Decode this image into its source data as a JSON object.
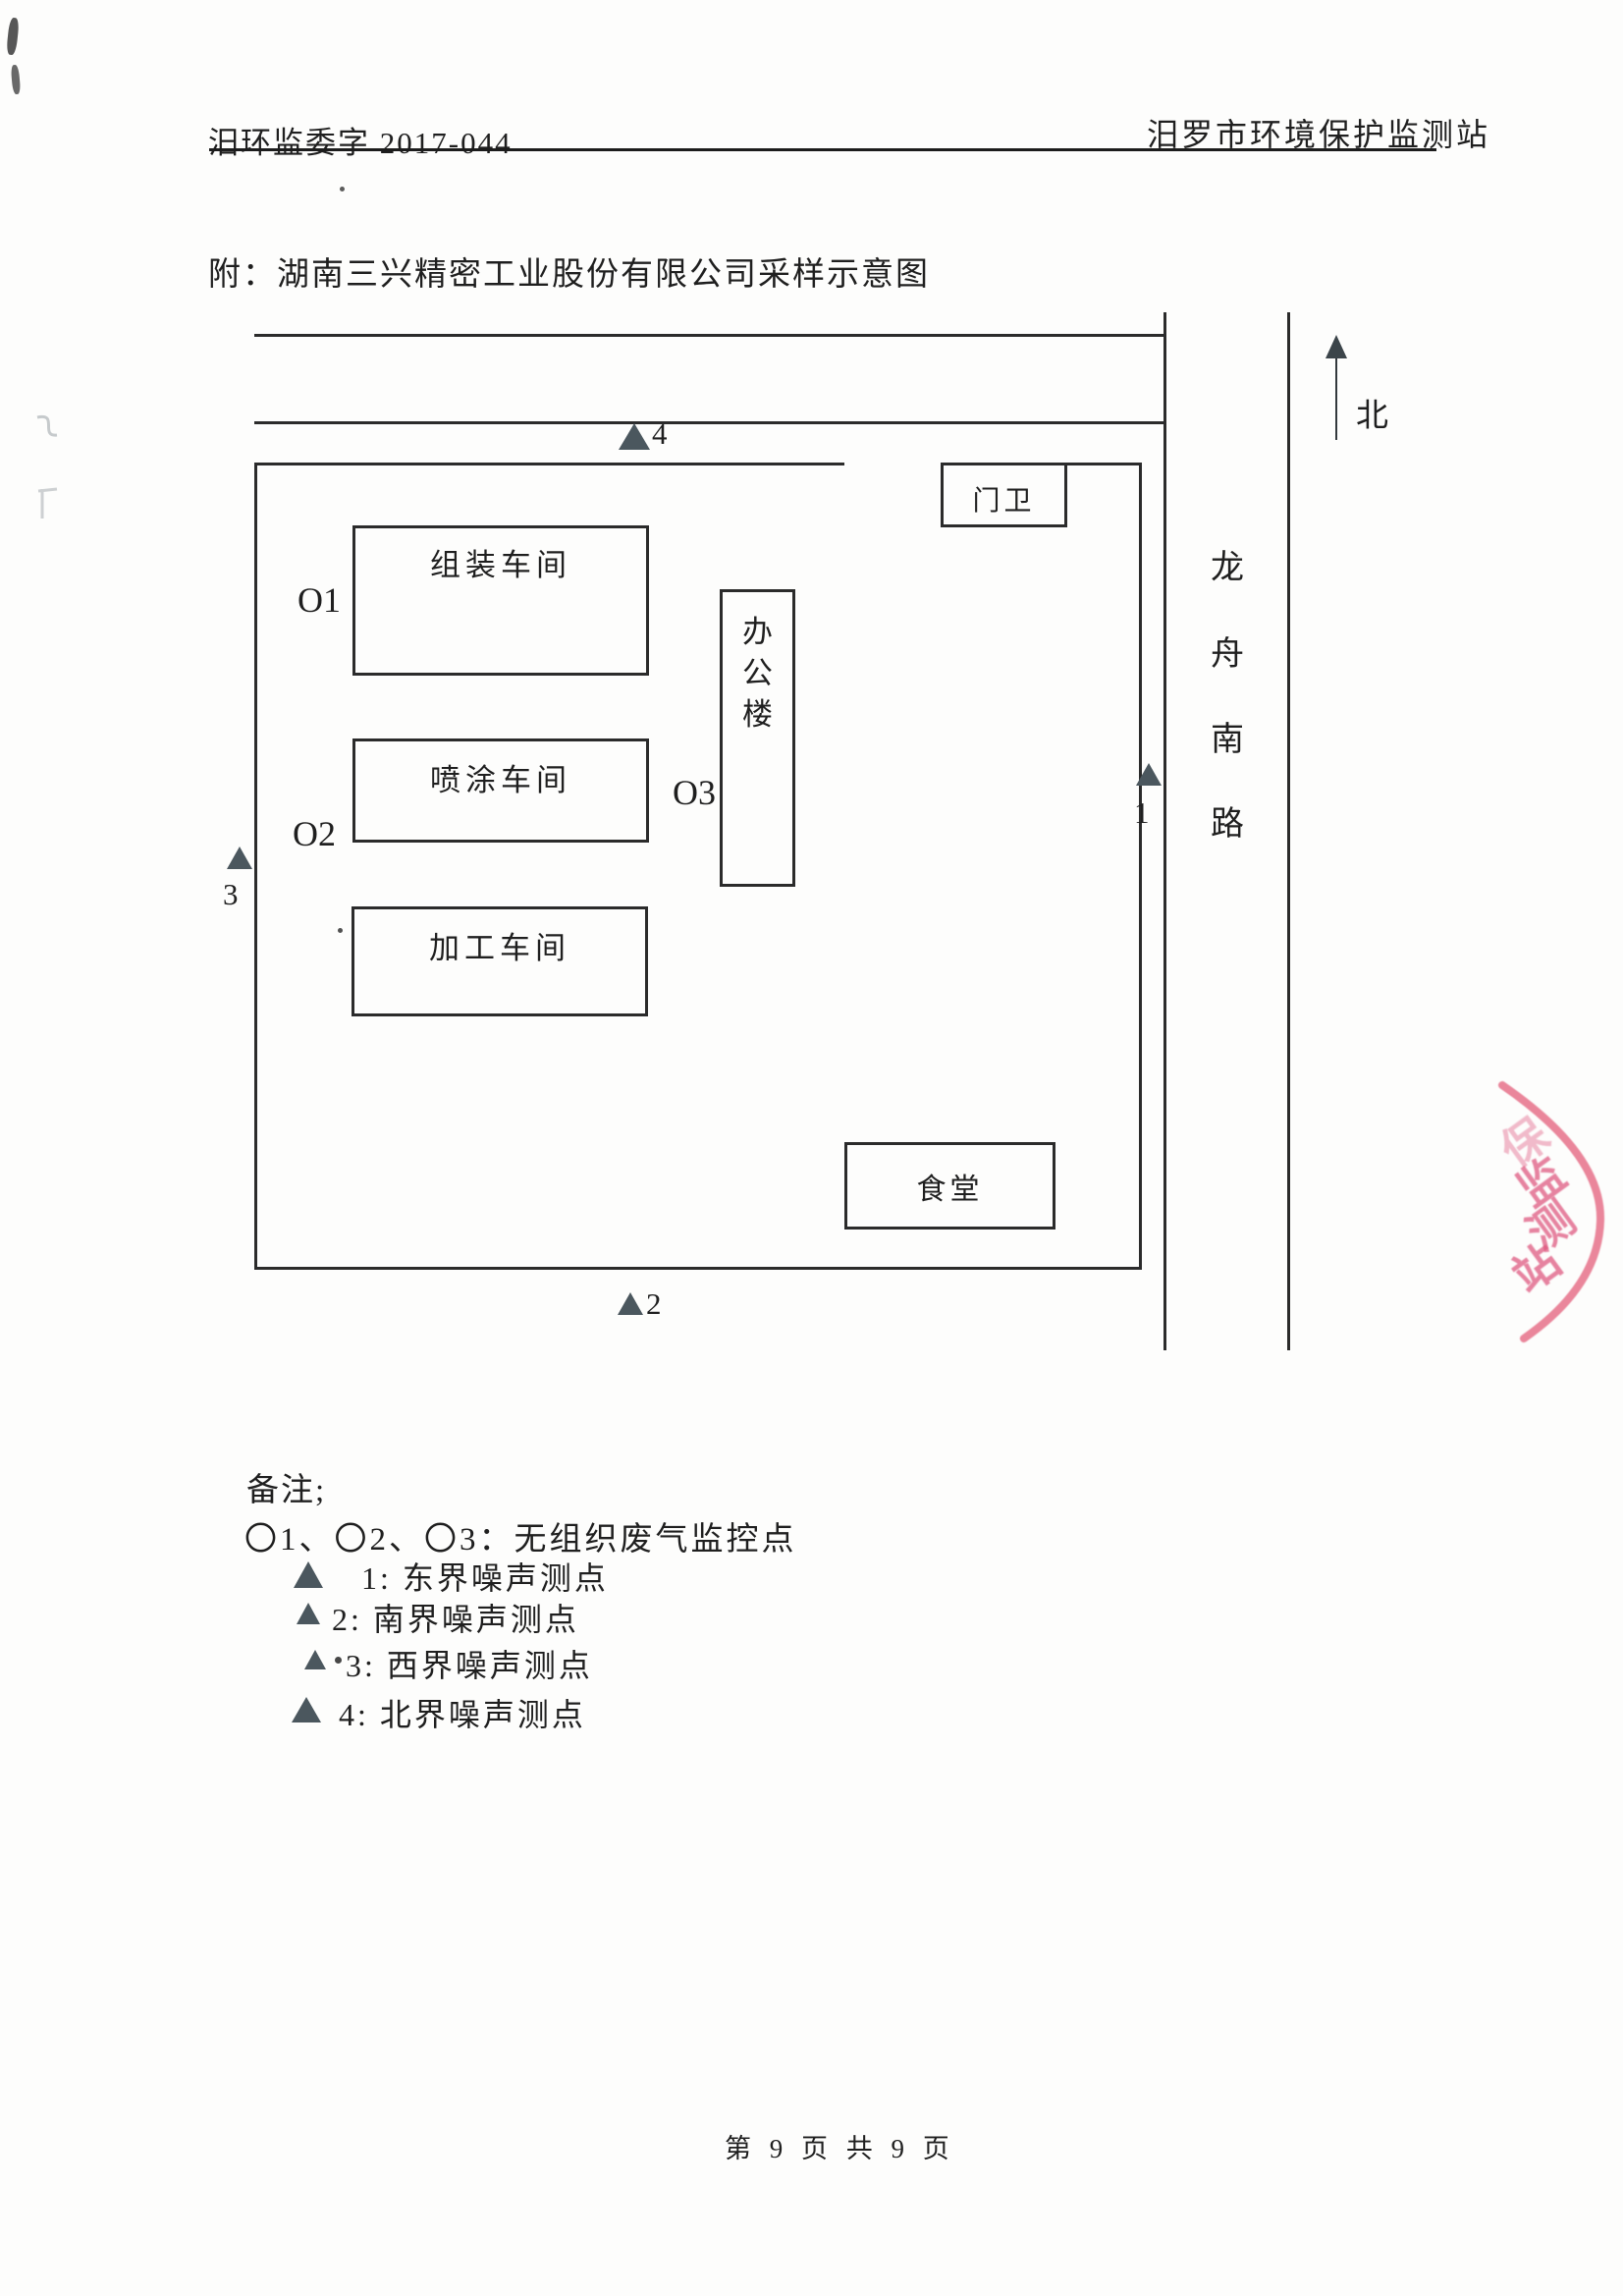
{
  "document": {
    "header_left": "汨环监委字 2017-044",
    "header_right": "汨罗市环境保护监测站",
    "title": "附：湖南三兴精密工业股份有限公司采样示意图",
    "footer": "第 9 页 共 9 页"
  },
  "diagram": {
    "north_label": "北",
    "road_name": "龙舟南路",
    "road_chars": [
      "龙",
      "舟",
      "南",
      "路"
    ],
    "buildings": {
      "gatehouse": "门卫",
      "assembly_workshop": "组装车间",
      "spray_workshop": "喷涂车间",
      "office_building": "办公楼",
      "office_chars": [
        "办",
        "公",
        "楼"
      ],
      "processing_workshop": "加工车间",
      "canteen": "食堂"
    },
    "gas_monitor_points": {
      "o1": "O1",
      "o2": "O2",
      "o3": "O3"
    },
    "noise_markers": {
      "n1": "1",
      "n2": "2",
      "n3": "3",
      "n4": "4"
    }
  },
  "notes": {
    "heading": "备注;",
    "gas_line": "〇1、〇2、〇3：无组织废气监控点",
    "legend": [
      "1: 东界噪声测点",
      "2: 南界噪声测点",
      "3: 西界噪声测点",
      "4: 北界噪声测点"
    ]
  },
  "stamp": {
    "chars": [
      "保",
      "监",
      "测",
      "站"
    ],
    "color": "#e25a7d"
  },
  "colors": {
    "ink": "#2b2b2b",
    "marker_fill": "#4b575e",
    "paper": "#fdfdfc"
  }
}
